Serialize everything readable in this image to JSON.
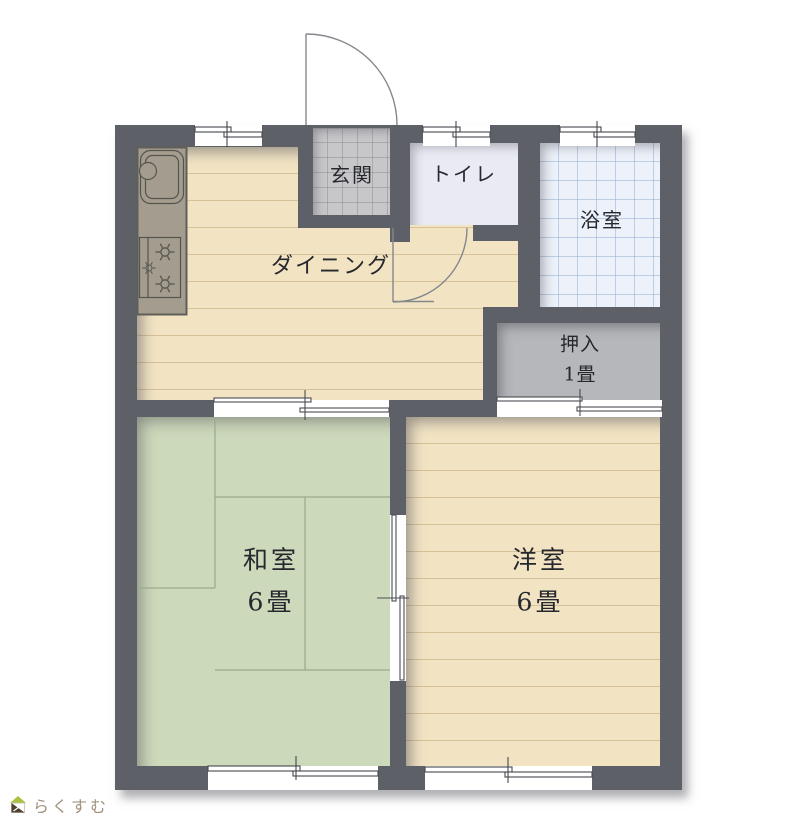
{
  "rooms": {
    "dining": {
      "label": "ダイニング"
    },
    "genkan": {
      "label": "玄関"
    },
    "toilet": {
      "label": "トイレ"
    },
    "bath": {
      "label": "浴室"
    },
    "oshiire": {
      "label": "押入",
      "size": "1畳"
    },
    "washitsu": {
      "label": "和室",
      "size": "6畳"
    },
    "youshitsu": {
      "label": "洋室",
      "size": "6畳"
    }
  },
  "fixtures": {
    "kitchen_sink": "sink-with-faucet",
    "kitchen_stove": "three-burner-stove",
    "entrance_door": "hinged-door-swing-arc",
    "toilet_door": "hinged-door-swing-arc",
    "sliding_doors": 3,
    "windows": 5
  },
  "logo": {
    "text": "らくすむ"
  },
  "colors": {
    "wall": "#5d6066",
    "wood": "#f2e4c3",
    "tatami": "#cdd9bb",
    "tile": "#c7c7ca",
    "toilet": "#e9eaf3",
    "bath": "#edf2fa",
    "closet": "#b6b7bb",
    "label": "#26282e",
    "counter": "#a49d8f",
    "logo_text": "#a2927f",
    "logo_accent": "#a9c23f"
  }
}
